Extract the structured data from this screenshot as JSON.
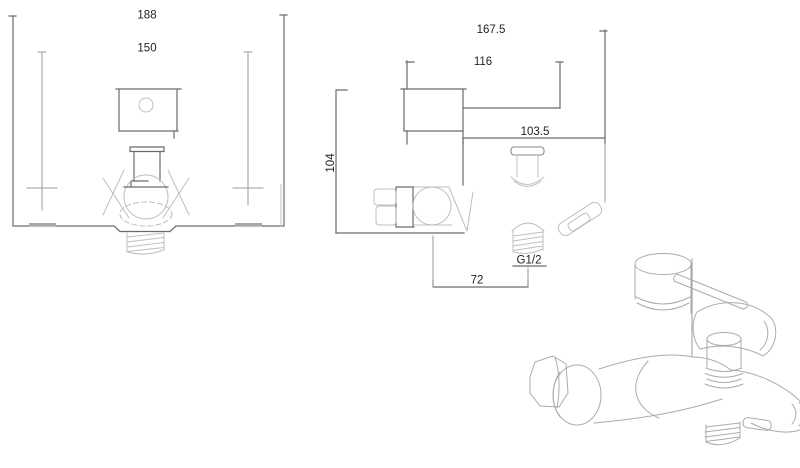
{
  "colors": {
    "background": "#ffffff",
    "dark_line": "#6b6b6b",
    "light_line": "#bfbfbf",
    "text": "#222222"
  },
  "front_view": {
    "overall_width": "188",
    "inlet_center_distance": "150"
  },
  "side_view": {
    "overall_depth": "167.5",
    "handle_reach": "116",
    "spout_reach": "103.5",
    "body_height": "104",
    "outlet_offset": "72",
    "connection_thread": "G1/2"
  }
}
